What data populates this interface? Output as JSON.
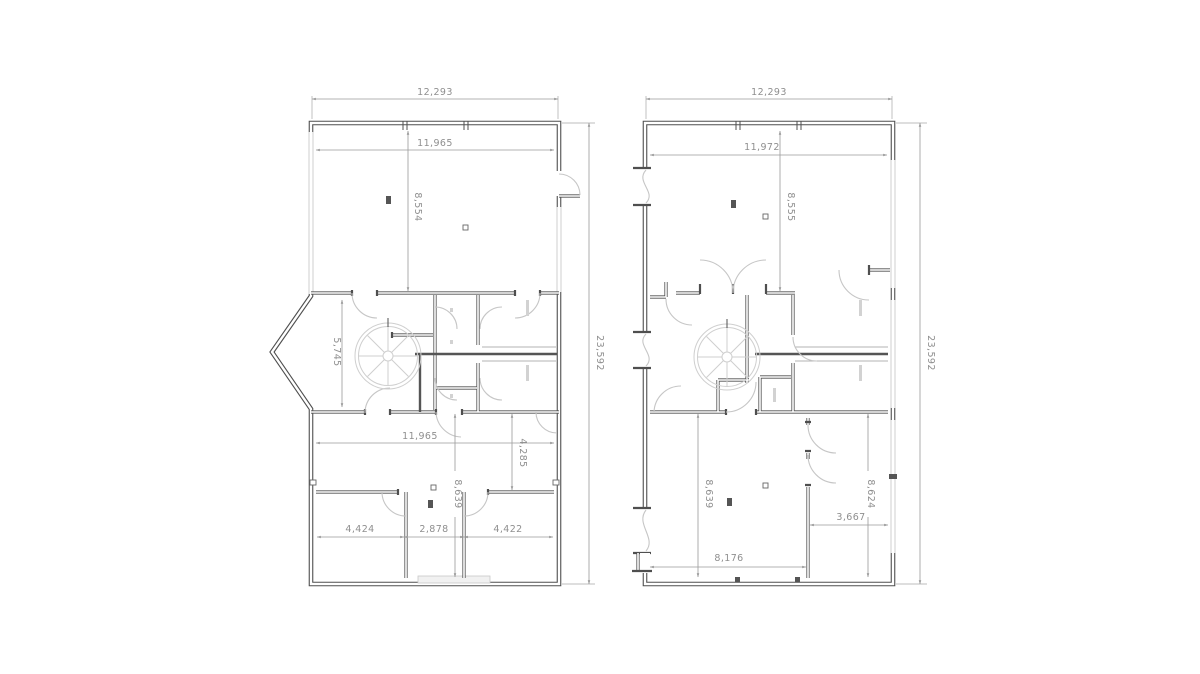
{
  "document": {
    "type": "cad-floor-plan-sheet",
    "background": "#ffffff",
    "wall_color": "#4f4f4f",
    "light_detail_color": "#cfcfcf",
    "dimension_color": "#8f8f8f"
  },
  "plans": {
    "left": {
      "name": "left-floor-plan",
      "dims": {
        "total_width": "12,293",
        "inner_width_top": "11,965",
        "room_height_top": "8,554",
        "bay_height": "5,745",
        "inner_width_mid": "11,965",
        "right_room_height": "4,285",
        "lower_room_height": "8,639",
        "bottom_left": "4,424",
        "bottom_mid": "2,878",
        "bottom_right": "4,422",
        "total_height": "23,592"
      }
    },
    "right": {
      "name": "right-floor-plan",
      "dims": {
        "total_width": "12,293",
        "inner_width_top": "11,972",
        "room_height_top": "8,555",
        "lower_left_height": "8,639",
        "lower_right_height": "8,624",
        "closet_width": "3,667",
        "bottom_width": "8,176",
        "total_height": "23,592"
      }
    }
  }
}
